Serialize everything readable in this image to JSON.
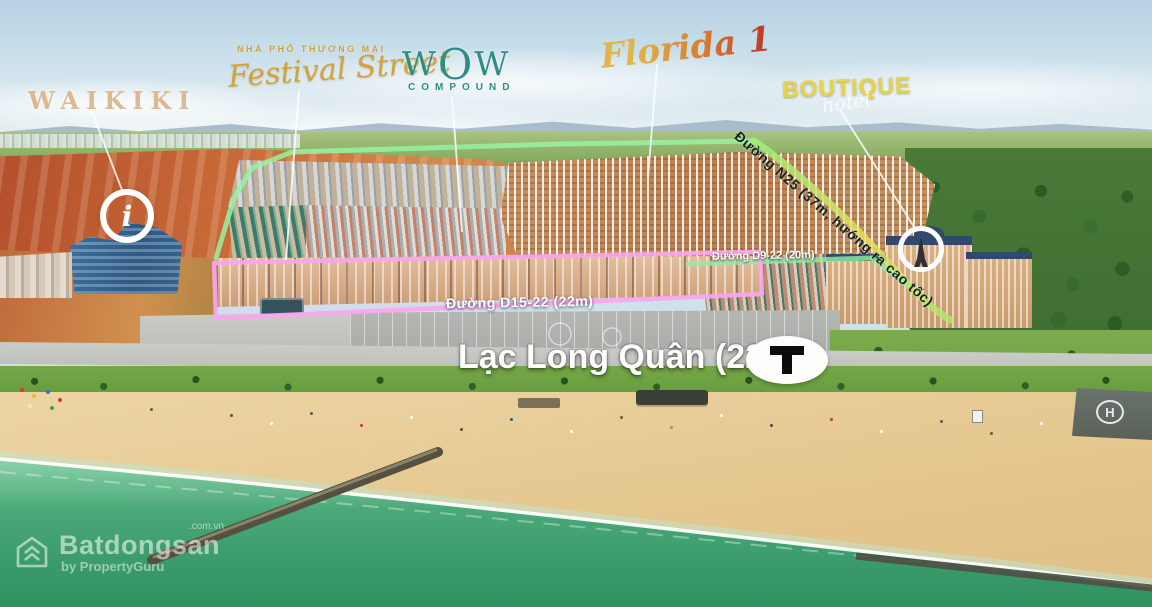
{
  "zones": {
    "waikiki": {
      "label": "WAIKIKI"
    },
    "festival": {
      "kicker": "NHÀ PHỐ THƯƠNG MẠI",
      "label": "Festival Street"
    },
    "wow": {
      "label_w1": "W",
      "label_o": "O",
      "label_w2": "W",
      "sub": "COMPOUND"
    },
    "florida": {
      "label": "Florida 1"
    },
    "boutique": {
      "label": "BOUTIQUE",
      "sub": "hotel"
    }
  },
  "roads": {
    "n25": {
      "label": "Đường N25 (37m, hướng ra cao tốc)"
    },
    "d9_22": {
      "label": "Đường D9-22 (20m)"
    },
    "d15_22": {
      "label": "Đường D15-22 (22m)"
    },
    "main": {
      "label": "Lạc Long Quân (22m)"
    }
  },
  "badges": {
    "info": {
      "glyph": "i"
    },
    "helipad": {
      "glyph": "H"
    }
  },
  "watermark": {
    "brand": "Batdongsan",
    "domain": ".com.vn",
    "byline": "by PropertyGuru"
  },
  "colors": {
    "outline_green": "#97f2a2",
    "outline_pink": "#fba6ee",
    "n25_gradient_end": "#e6e05e",
    "boutique_yellow": "#e7d348",
    "festival_gold": "#d2a33c",
    "wow_teal": "#2f8d86",
    "waikiki_tan": "#dcb489",
    "sea_deep": "#2f9060",
    "sea_shallow": "#86cfa8",
    "sand": "#e6c992"
  }
}
